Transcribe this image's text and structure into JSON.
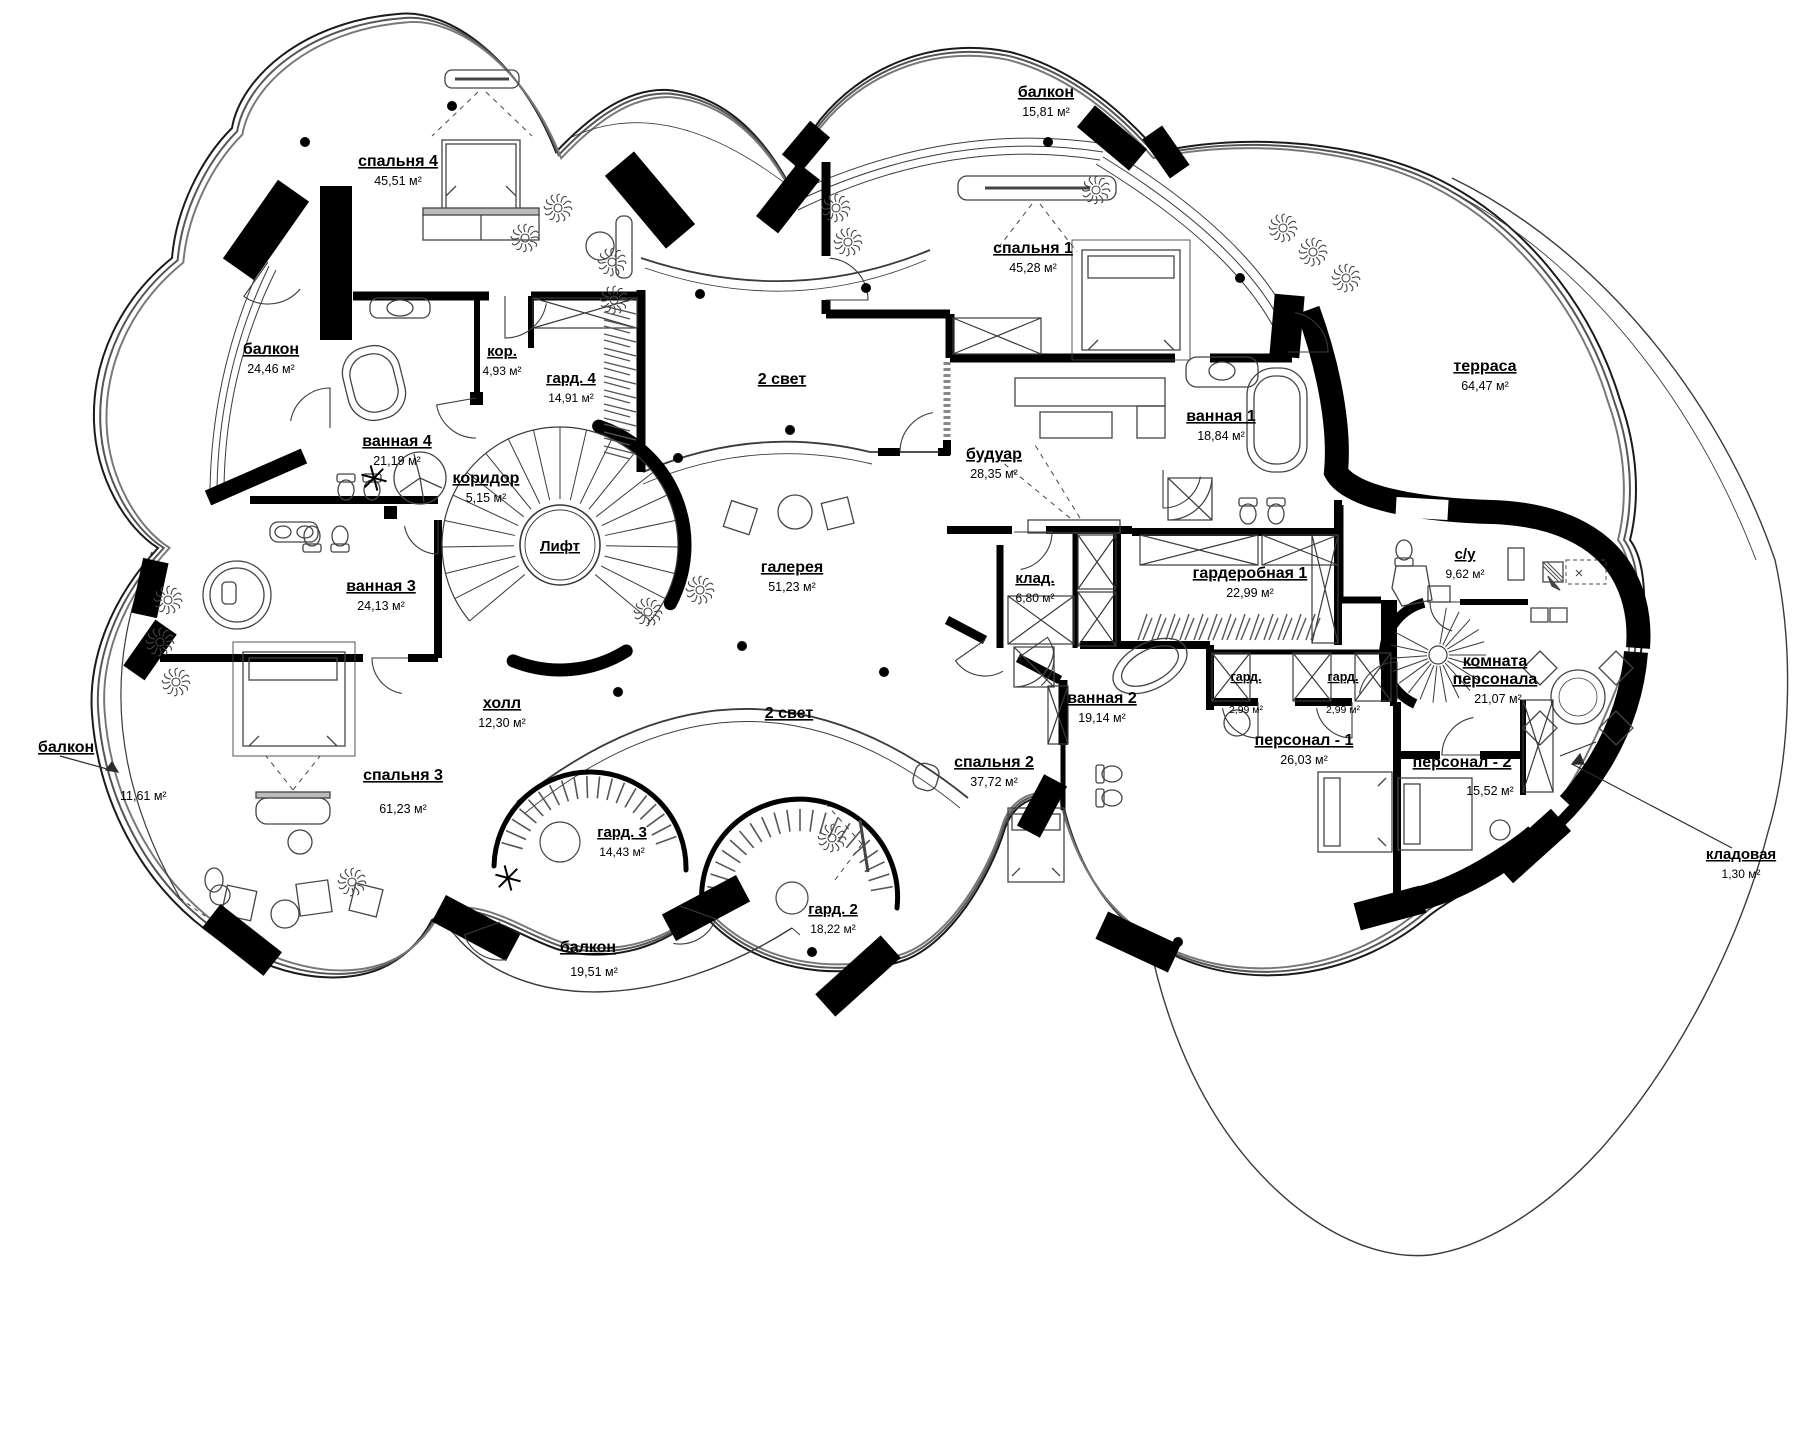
{
  "page": {
    "background": "#ffffff",
    "wall_color": "#000000",
    "line_color": "#2b2b2b",
    "furniture_color": "#444444"
  },
  "plan": {
    "type": "architectural floor plan, second level of a villa (Russian labels)",
    "elevator_label": "Лифт",
    "area_unit": "м²",
    "rooms": [
      {
        "name": "спальня 4",
        "area": "45,51 м²"
      },
      {
        "name": "балкон",
        "area": "15,81 м²"
      },
      {
        "name": "спальня 1",
        "area": "45,28 м²"
      },
      {
        "name": "балкон",
        "area": "24,46 м²"
      },
      {
        "name": "кор.",
        "area": "4,93 м²"
      },
      {
        "name": "гард. 4",
        "area": "14,91 м²"
      },
      {
        "name": "2 свет",
        "area": ""
      },
      {
        "name": "ванная 4",
        "area": "21,19 м²"
      },
      {
        "name": "терраса",
        "area": "64,47 м²"
      },
      {
        "name": "ванная 1",
        "area": "18,84 м²"
      },
      {
        "name": "будуар",
        "area": "28,35 м²"
      },
      {
        "name": "коридор",
        "area": "5,15 м²"
      },
      {
        "name": "Лифт",
        "area": ""
      },
      {
        "name": "галерея",
        "area": "51,23 м²"
      },
      {
        "name": "клад.",
        "area": "6,80 м²"
      },
      {
        "name": "гардеробная 1",
        "area": "22,99 м²"
      },
      {
        "name": "с/у",
        "area": "9,62 м²"
      },
      {
        "name": "ванная 3",
        "area": "24,13 м²"
      },
      {
        "name": "комната персонала",
        "area": "21,07 м²"
      },
      {
        "name": "гард.",
        "area": "2,99 м²"
      },
      {
        "name": "гард.",
        "area": "2,99 м²"
      },
      {
        "name": "холл",
        "area": "12,30 м²"
      },
      {
        "name": "2 свет",
        "area": ""
      },
      {
        "name": "ванная 2",
        "area": "19,14 м²"
      },
      {
        "name": "балкон",
        "area": "11,61 м²"
      },
      {
        "name": "спальня 2",
        "area": "37,72 м²"
      },
      {
        "name": "персонал - 1",
        "area": "26,03 м²"
      },
      {
        "name": "персонал - 2",
        "area": "15,52 м²"
      },
      {
        "name": "спальня 3",
        "area": "61,23 м²"
      },
      {
        "name": "гард. 3",
        "area": "14,43 м²"
      },
      {
        "name": "гард. 2",
        "area": "18,22 м²"
      },
      {
        "name": "балкон",
        "area": "19,51 м²"
      },
      {
        "name": "кладовая",
        "area": "1,30 м²"
      }
    ]
  }
}
